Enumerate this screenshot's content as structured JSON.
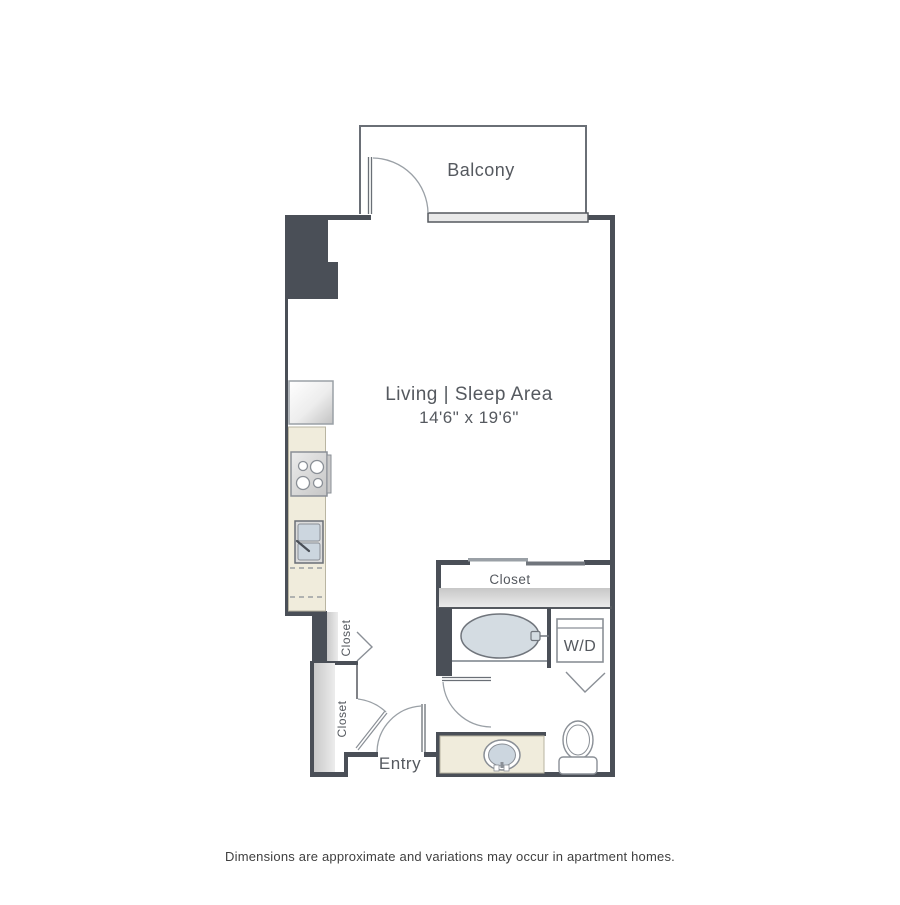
{
  "floor_plan": {
    "balcony": {
      "label": "Balcony"
    },
    "living_sleep_area": {
      "label": "Living | Sleep Area",
      "dimensions": "14'6\" x 19'6\""
    },
    "bath_closet": {
      "label": "Closet"
    },
    "hall_closet_small": {
      "label": "Closet"
    },
    "hall_closet_large": {
      "label": "Closet"
    },
    "washer_dryer": {
      "label": "W/D"
    },
    "entry": {
      "label": "Entry"
    }
  },
  "footer": {
    "disclaimer": "Dimensions are approximate and variations may occur in apartment homes."
  },
  "colors": {
    "wall_dark": "#4a4f57",
    "line_dark": "#55595f",
    "line_medium": "#8a8f96",
    "line_light": "#9aa0a6",
    "counter_beige": "#f0ecdc",
    "fixture_blue": "#ccd6df",
    "tub_blue": "#d4dce2",
    "shelf_gray": "#d9d9d9",
    "text_gray": "#55595f",
    "disclaimer_text": "#3f3f3f"
  }
}
